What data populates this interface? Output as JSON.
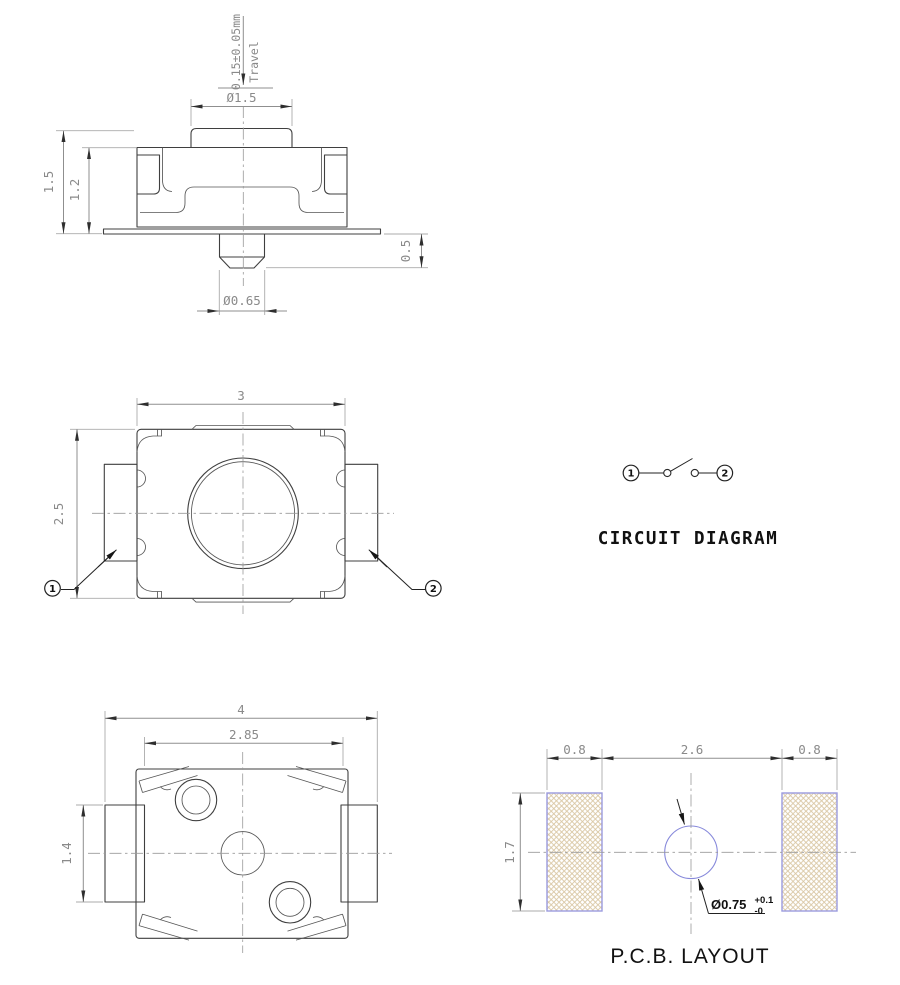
{
  "side_view": {
    "travel_value": "0.15±0.05mm",
    "travel_label": "Travel",
    "actuator_dia": "Ø1.5",
    "total_height": "1.5",
    "body_height": "1.2",
    "stem_height": "0.5",
    "stem_dia": "Ø0.65"
  },
  "top_view": {
    "width": "3",
    "depth": "2.5",
    "terminal_1": "1",
    "terminal_2": "2"
  },
  "circuit_diagram": {
    "title": "CIRCUIT DIAGRAM",
    "terminal_1": "1",
    "terminal_2": "2"
  },
  "bottom_view": {
    "overall_width": "4",
    "body_width": "2.85",
    "terminal_height": "1.4"
  },
  "pcb_layout": {
    "title": "P.C.B. LAYOUT",
    "left_pad_width": "0.8",
    "pad_gap": "2.6",
    "right_pad_width": "0.8",
    "pad_height": "1.7",
    "hole_dia": "Ø0.75",
    "hole_tol_plus": "+0.1",
    "hole_tol_minus": "-0"
  },
  "colors": {
    "object_line": "#3f3f3f",
    "dimension_line": "#8f8f8f",
    "dimension_text": "#8a8a8a",
    "black_text": "#111111",
    "arrow": "#2e2e2e",
    "pad_border": "#9b9bdf",
    "pad_hatch": "#d9c6a2",
    "hole_outline": "#8789db"
  }
}
